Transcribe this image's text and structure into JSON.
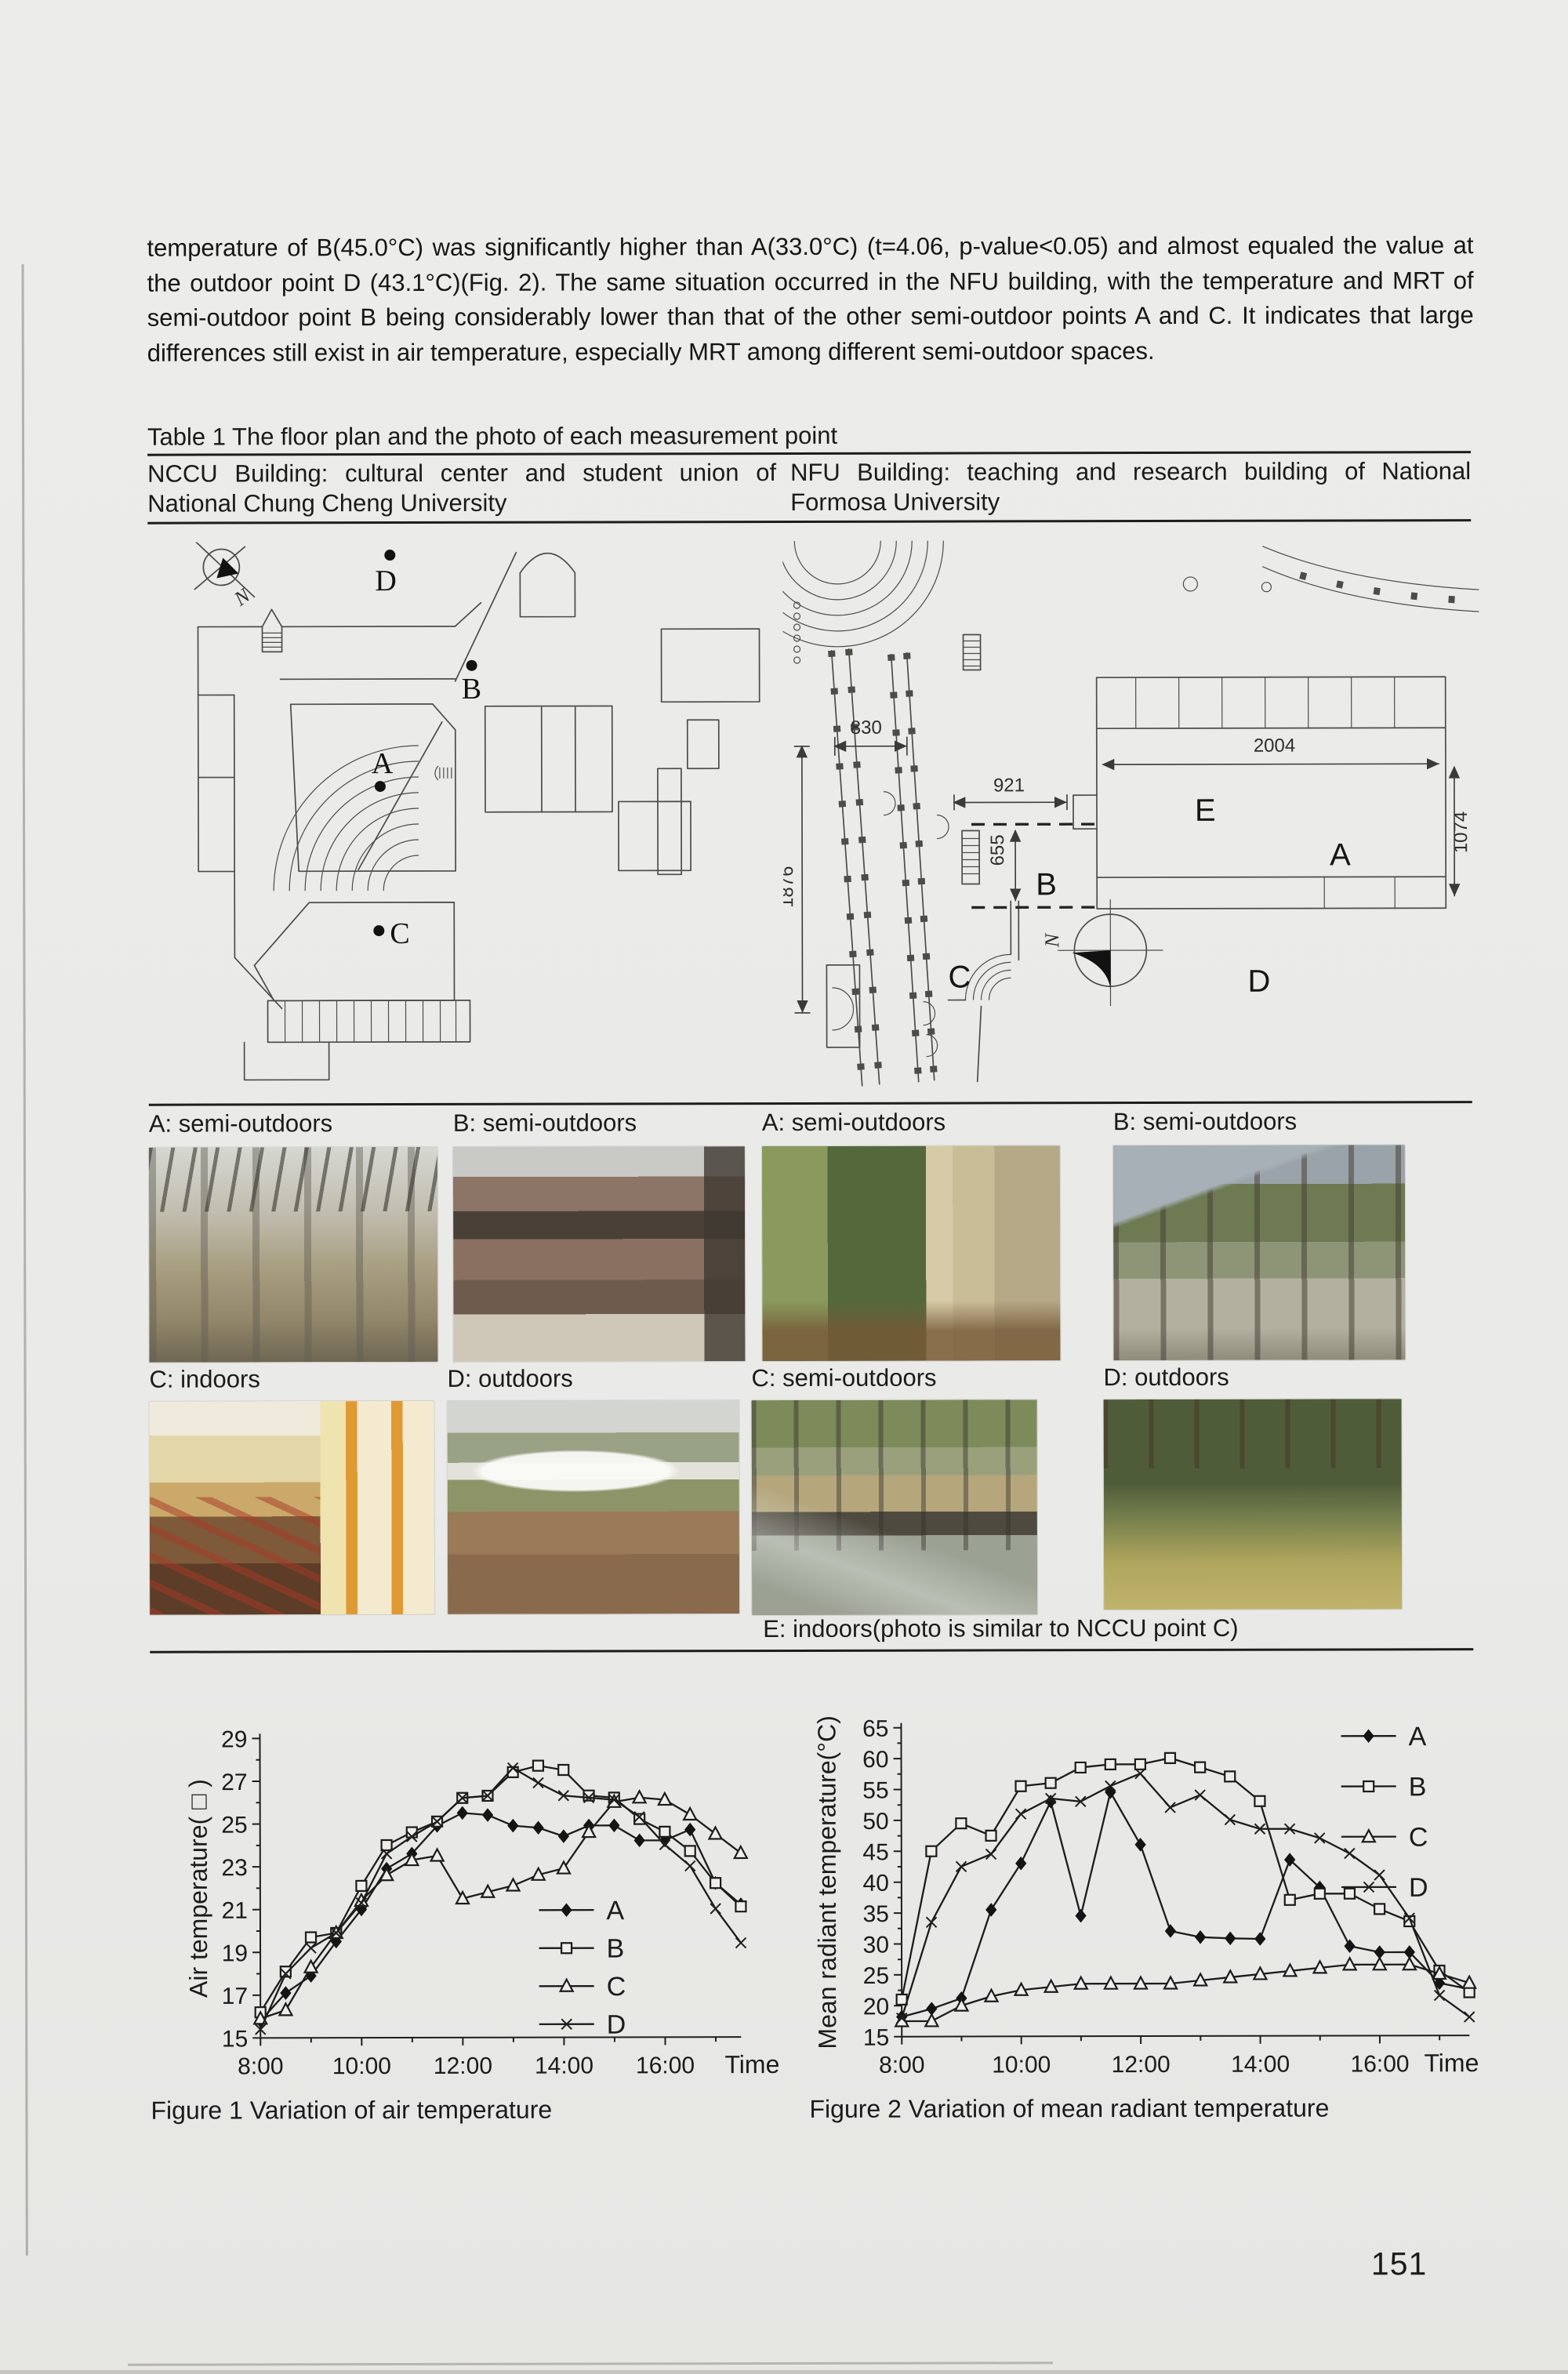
{
  "page": {
    "number": "151"
  },
  "intro": {
    "text": "temperature of B(45.0°C) was significantly higher than A(33.0°C) (t=4.06, p-value<0.05) and almost equaled the value at the outdoor point D (43.1°C)(Fig. 2). The same situation occurred in the NFU building, with the temperature and MRT of semi-outdoor point B being considerably lower than that of the other semi-outdoor points A and C. It indicates that large differences still exist in air temperature, especially MRT among different semi-outdoor spaces."
  },
  "table1": {
    "title": "Table 1 The floor plan and the photo of each measurement point",
    "columns": [
      {
        "header": "NCCU Building: cultural center and student union of National Chung Cheng University"
      },
      {
        "header": "NFU Building: teaching and research building of National Formosa University"
      }
    ],
    "nccu_plan": {
      "label_a": "A",
      "label_b": "B",
      "label_c": "C",
      "label_d": "D",
      "north": "N"
    },
    "nfu_plan": {
      "label_a": "A",
      "label_b": "B",
      "label_c": "C",
      "label_d": "D",
      "label_e": "E",
      "north": "N",
      "dim_corridor_width": "830",
      "dim_gap": "921",
      "dim_b_height": "655",
      "dim_corridor_length": "1876",
      "dim_building_width": "2004",
      "dim_building_height": "1074"
    },
    "photo_rows": [
      [
        {
          "caption": "A: semi-outdoors"
        },
        {
          "caption": "B: semi-outdoors"
        },
        {
          "caption": "A: semi-outdoors"
        },
        {
          "caption": "B: semi-outdoors"
        }
      ],
      [
        {
          "caption": "C: indoors"
        },
        {
          "caption": "D: outdoors"
        },
        {
          "caption": "C: semi-outdoors"
        },
        {
          "caption": "D: outdoors"
        }
      ]
    ],
    "e_note": "E: indoors(photo is similar to NCCU point C)"
  },
  "chart_data": [
    {
      "type": "line",
      "title": "Figure 1 Variation of air temperature",
      "xlabel": "Time",
      "ylabel": "Air temperature( □ )",
      "ylim": [
        15,
        29
      ],
      "yticks": [
        15,
        17,
        19,
        21,
        23,
        25,
        27,
        29
      ],
      "xticks": [
        "8:00",
        "10:00",
        "12:00",
        "14:00",
        "16:00"
      ],
      "x": [
        "8:00",
        "8:30",
        "9:00",
        "9:30",
        "10:00",
        "10:30",
        "11:00",
        "11:30",
        "12:00",
        "12:30",
        "13:00",
        "13:30",
        "14:00",
        "14:30",
        "15:00",
        "15:30",
        "16:00",
        "16:30",
        "17:00",
        "17:30"
      ],
      "grid": false,
      "legend": [
        "A",
        "B",
        "C",
        "D"
      ],
      "legend_position": "inside lower right",
      "series": [
        {
          "name": "A",
          "marker": "diamond-filled",
          "values": [
            15.8,
            17.1,
            17.9,
            19.5,
            21.0,
            22.9,
            23.6,
            24.9,
            25.5,
            25.4,
            24.9,
            24.8,
            24.4,
            24.9,
            24.9,
            24.2,
            24.2,
            24.7,
            22.2,
            21.2
          ]
        },
        {
          "name": "B",
          "marker": "square-open",
          "values": [
            16.2,
            18.1,
            19.7,
            19.9,
            22.1,
            24.0,
            24.6,
            25.1,
            26.2,
            26.3,
            27.4,
            27.7,
            27.5,
            26.3,
            26.2,
            25.2,
            24.6,
            23.7,
            22.2,
            21.1
          ]
        },
        {
          "name": "C",
          "marker": "triangle-open",
          "values": [
            15.9,
            16.3,
            18.3,
            19.9,
            21.4,
            22.6,
            23.3,
            23.5,
            21.5,
            21.8,
            22.1,
            22.6,
            22.9,
            24.6,
            26.0,
            26.2,
            26.1,
            25.4,
            24.5,
            23.6
          ]
        },
        {
          "name": "D",
          "marker": "x",
          "values": [
            15.4,
            18.0,
            19.2,
            19.9,
            21.3,
            23.6,
            24.4,
            25.1,
            26.2,
            26.3,
            27.6,
            26.9,
            26.3,
            26.2,
            26.1,
            25.3,
            24.0,
            23.0,
            21.0,
            19.4
          ]
        }
      ]
    },
    {
      "type": "line",
      "title": "Figure 2 Variation of mean radiant temperature",
      "xlabel": "Time",
      "ylabel": "Mean radiant temperature(°C)",
      "ylim": [
        15,
        65
      ],
      "yticks": [
        15,
        20,
        25,
        30,
        35,
        40,
        45,
        50,
        55,
        60,
        65
      ],
      "xticks": [
        "8:00",
        "10:00",
        "12:00",
        "14:00",
        "16:00"
      ],
      "x": [
        "8:00",
        "8:30",
        "9:00",
        "9:30",
        "10:00",
        "10:30",
        "11:00",
        "11:30",
        "12:00",
        "12:30",
        "13:00",
        "13:30",
        "14:00",
        "14:30",
        "15:00",
        "15:30",
        "16:00",
        "16:30",
        "17:00",
        "17:30"
      ],
      "grid": false,
      "legend": [
        "A",
        "B",
        "C",
        "D"
      ],
      "legend_position": "top right",
      "series": [
        {
          "name": "A",
          "marker": "diamond-filled",
          "values": [
            18.2,
            19.5,
            21.2,
            35.5,
            43.0,
            53.0,
            34.5,
            54.5,
            46.0,
            32.0,
            31.0,
            30.8,
            30.7,
            43.5,
            39.0,
            29.5,
            28.5,
            28.5,
            23.5,
            22.5
          ]
        },
        {
          "name": "B",
          "marker": "square-open",
          "values": [
            21.0,
            45.0,
            49.5,
            47.5,
            55.5,
            56.0,
            58.5,
            59.0,
            59.0,
            60.0,
            58.5,
            57.0,
            53.0,
            37.0,
            38.0,
            38.0,
            35.5,
            33.5,
            25.5,
            22.0
          ]
        },
        {
          "name": "C",
          "marker": "triangle-open",
          "values": [
            17.5,
            17.5,
            20.0,
            21.5,
            22.5,
            23.0,
            23.5,
            23.5,
            23.5,
            23.5,
            24.0,
            24.5,
            25.0,
            25.5,
            26.0,
            26.5,
            26.5,
            26.5,
            25.0,
            23.5
          ]
        },
        {
          "name": "D",
          "marker": "x",
          "values": [
            18.0,
            33.5,
            42.5,
            44.5,
            51.0,
            53.5,
            53.0,
            55.5,
            57.5,
            52.0,
            54.0,
            50.0,
            48.5,
            48.5,
            47.0,
            44.5,
            41.0,
            34.0,
            21.5,
            18.0
          ]
        }
      ]
    }
  ]
}
